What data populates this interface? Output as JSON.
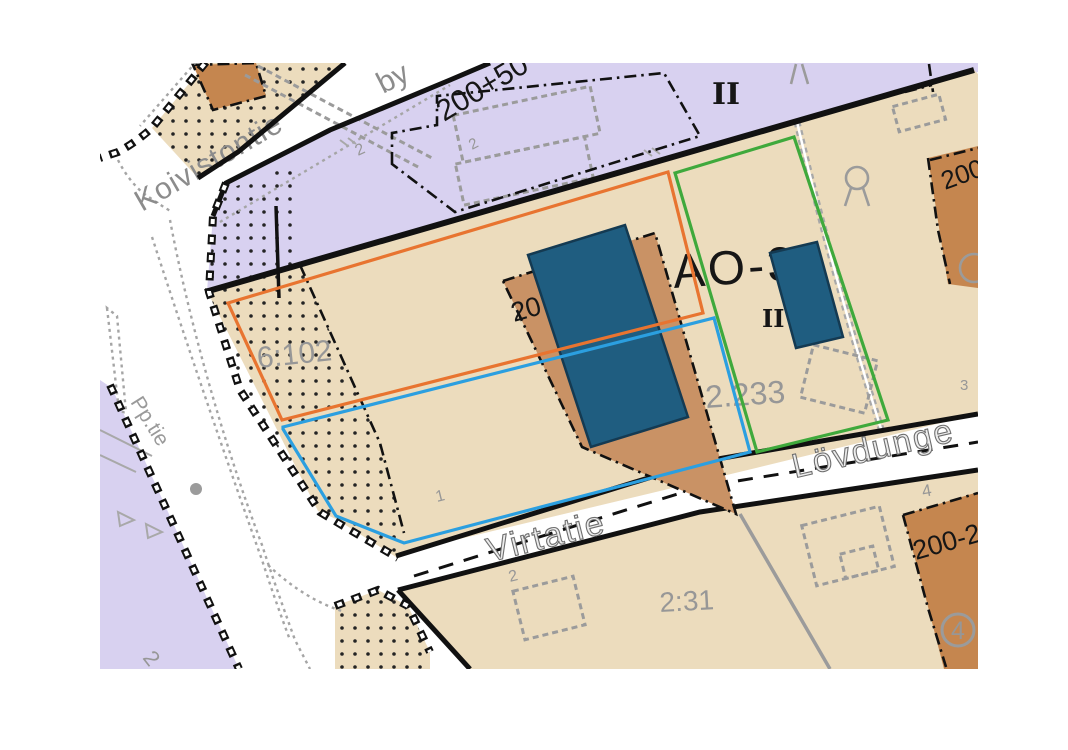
{
  "map": {
    "title": "detailed-plan-cadastral-map",
    "colors": {
      "zone_purple": "#d8d1f0",
      "zone_beige": "#ecdcbd",
      "brown": "#c5864f",
      "building_blue": "#1f5d80",
      "building_stroke": "#143a52",
      "outline_orange": "#e87430",
      "outline_green": "#3fa93c",
      "outline_blue": "#2b9fe0",
      "gray": "#9b9b9b",
      "black": "#111111"
    },
    "roads": {
      "koivistontie": "Koivistontie",
      "koivistontie_suffix": "by",
      "pp_tie": "Pp.tie",
      "virtatie": "Virtatie",
      "lovdunge": "Lövdunge"
    },
    "zones": {
      "plan_number_top": "200+50",
      "block_code": "AO-36",
      "storeys_top": "II",
      "storeys_small": "II",
      "plan_number_topright": "200-2",
      "plan_number_bottomright": "200-2"
    },
    "parcels": {
      "p6102": "6:102",
      "p2233": "2.233",
      "p231": "2:31",
      "building_pad_label": "20",
      "circled_number": "4"
    },
    "small_numbers": {
      "n2_near_road": "2",
      "n2_purple_top": "2",
      "n1_lot": "1",
      "n2_lot": "2",
      "n4_lot": "4",
      "n3_lot": "3",
      "n2_bottom_left": "2"
    }
  }
}
